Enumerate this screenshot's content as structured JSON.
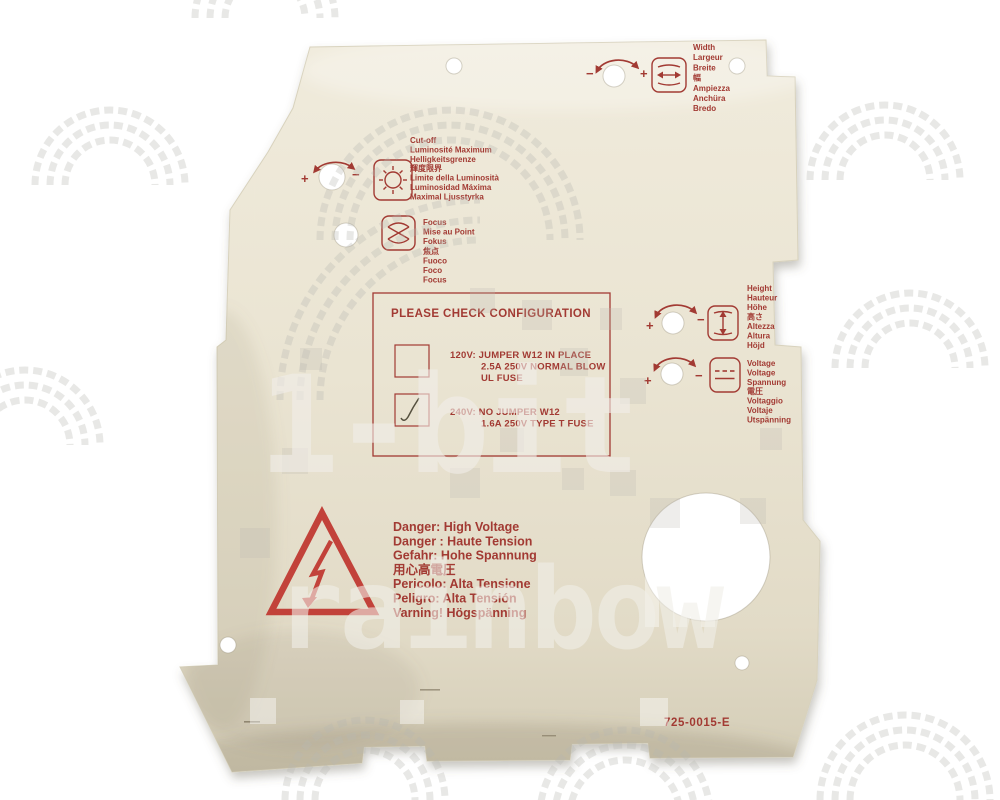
{
  "colors": {
    "background": "#ffffff",
    "plate_beige": "#e9e3d1",
    "print_red": "#a23a33",
    "triangle_red": "#c2423a",
    "pen_check": "#55503f"
  },
  "symbols": {
    "plus": "+",
    "minus": "−"
  },
  "controls": {
    "cutoff": {
      "icon": "sun-brightness-icon",
      "lines": [
        "Cut-off",
        "Luminosité Maximum",
        "Helligkeitsgrenze",
        "輝度限界",
        "Limite della Luminosità",
        "Luminosidad Máxima",
        "Maximal Ljusstyrka"
      ]
    },
    "focus": {
      "icon": "lens-focus-icon",
      "lines": [
        "Focus",
        "Mise au Point",
        "Fokus",
        "焦点",
        "Fuoco",
        "Foco",
        "Focus"
      ]
    },
    "width": {
      "icon": "horizontal-size-icon",
      "lines": [
        "Width",
        "Largeur",
        "Breite",
        "幅",
        "Ampiezza",
        "Anchüra",
        "Bredo"
      ]
    },
    "height": {
      "icon": "vertical-size-icon",
      "lines": [
        "Height",
        "Hauteur",
        "Höhe",
        "高さ",
        "Altezza",
        "Altura",
        "Höjd"
      ]
    },
    "voltage": {
      "icon": "dc-voltage-icon",
      "lines": [
        "Voltage",
        "Voltage",
        "Spannung",
        "電圧",
        "Voltaggio",
        "Voltaje",
        "Utspänning"
      ]
    }
  },
  "config_box": {
    "title": "PLEASE CHECK CONFIGURATION",
    "options": [
      {
        "checked": false,
        "lines": [
          "120V: JUMPER W12 IN PLACE",
          "2.5A 250V NORMAL BLOW",
          "UL FUSE"
        ]
      },
      {
        "checked": true,
        "lines": [
          "240V: NO JUMPER W12",
          "1.6A 250V TYPE T FUSE"
        ]
      }
    ]
  },
  "danger": {
    "lines": [
      "Danger: High Voltage",
      "Danger : Haute Tension",
      "Gefahr: Hohe Spannung",
      "用心高電圧",
      "Pericolo: Alta Tensione",
      "Peligro: Alta Tensión",
      "Varning! Högspänning"
    ]
  },
  "part_number": "725-0015-E",
  "watermark": {
    "line1": "1-bit",
    "line2": "rainbow"
  }
}
